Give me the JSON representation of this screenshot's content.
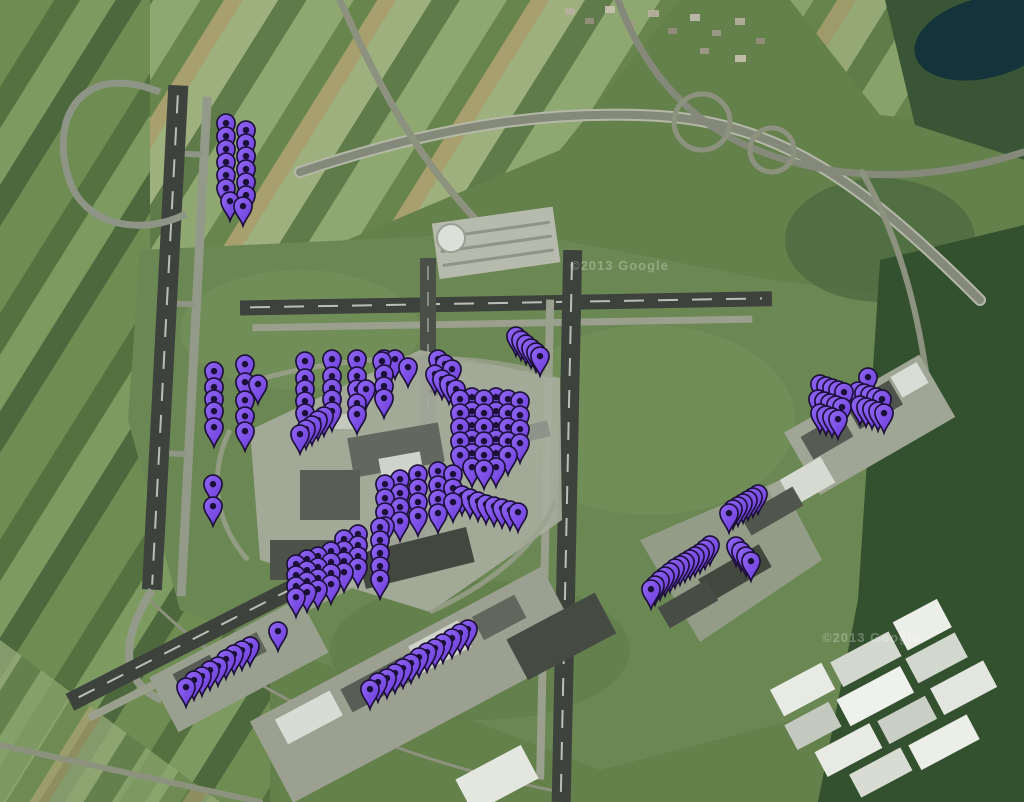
{
  "watermarks": [
    {
      "text": "©2013 Google"
    },
    {
      "text": "©2013 Google"
    }
  ],
  "markers": {
    "color": "#7a4ff0",
    "color_light": "#9168f4",
    "color_dark": "#6a3ad8",
    "outline": "#1c1038",
    "points": [
      [
        226,
        144
      ],
      [
        246,
        151
      ],
      [
        226,
        157
      ],
      [
        226,
        170
      ],
      [
        226,
        183
      ],
      [
        226,
        196
      ],
      [
        226,
        209
      ],
      [
        230,
        222
      ],
      [
        246,
        164
      ],
      [
        246,
        177
      ],
      [
        246,
        190
      ],
      [
        246,
        203
      ],
      [
        246,
        216
      ],
      [
        243,
        227
      ],
      [
        214,
        392
      ],
      [
        214,
        408
      ],
      [
        214,
        420
      ],
      [
        214,
        432
      ],
      [
        214,
        448
      ],
      [
        245,
        385
      ],
      [
        245,
        403
      ],
      [
        245,
        421
      ],
      [
        245,
        437
      ],
      [
        245,
        452
      ],
      [
        258,
        405
      ],
      [
        305,
        382
      ],
      [
        305,
        399
      ],
      [
        305,
        410
      ],
      [
        305,
        422
      ],
      [
        305,
        434
      ],
      [
        332,
        380
      ],
      [
        332,
        397
      ],
      [
        332,
        409
      ],
      [
        332,
        420
      ],
      [
        332,
        432
      ],
      [
        357,
        380
      ],
      [
        357,
        397
      ],
      [
        357,
        410
      ],
      [
        357,
        424
      ],
      [
        357,
        435
      ],
      [
        366,
        410
      ],
      [
        384,
        380
      ],
      [
        384,
        395
      ],
      [
        384,
        407
      ],
      [
        384,
        419
      ],
      [
        300,
        455
      ],
      [
        306,
        450
      ],
      [
        312,
        446
      ],
      [
        318,
        441
      ],
      [
        324,
        437
      ],
      [
        382,
        382
      ],
      [
        395,
        380
      ],
      [
        408,
        388
      ],
      [
        516,
        357
      ],
      [
        521,
        361
      ],
      [
        526,
        365
      ],
      [
        531,
        369
      ],
      [
        536,
        373
      ],
      [
        540,
        377
      ],
      [
        438,
        380
      ],
      [
        445,
        385
      ],
      [
        452,
        390
      ],
      [
        435,
        395
      ],
      [
        442,
        400
      ],
      [
        449,
        405
      ],
      [
        456,
        410
      ],
      [
        460,
        420
      ],
      [
        460,
        434
      ],
      [
        460,
        448
      ],
      [
        460,
        462
      ],
      [
        460,
        476
      ],
      [
        472,
        418
      ],
      [
        472,
        432
      ],
      [
        472,
        446
      ],
      [
        472,
        460
      ],
      [
        472,
        474
      ],
      [
        472,
        488
      ],
      [
        484,
        420
      ],
      [
        484,
        434
      ],
      [
        484,
        448
      ],
      [
        484,
        462
      ],
      [
        484,
        476
      ],
      [
        484,
        490
      ],
      [
        496,
        418
      ],
      [
        496,
        432
      ],
      [
        496,
        446
      ],
      [
        496,
        460
      ],
      [
        496,
        474
      ],
      [
        496,
        488
      ],
      [
        508,
        420
      ],
      [
        508,
        434
      ],
      [
        508,
        448
      ],
      [
        508,
        462
      ],
      [
        508,
        476
      ],
      [
        520,
        422
      ],
      [
        520,
        436
      ],
      [
        520,
        450
      ],
      [
        520,
        464
      ],
      [
        385,
        505
      ],
      [
        385,
        519
      ],
      [
        385,
        533
      ],
      [
        385,
        547
      ],
      [
        400,
        500
      ],
      [
        400,
        514
      ],
      [
        400,
        528
      ],
      [
        400,
        542
      ],
      [
        418,
        495
      ],
      [
        418,
        509
      ],
      [
        418,
        523
      ],
      [
        418,
        537
      ],
      [
        438,
        492
      ],
      [
        438,
        506
      ],
      [
        438,
        520
      ],
      [
        438,
        534
      ],
      [
        453,
        495
      ],
      [
        453,
        509
      ],
      [
        453,
        523
      ],
      [
        462,
        516
      ],
      [
        470,
        519
      ],
      [
        478,
        522
      ],
      [
        486,
        525
      ],
      [
        494,
        527
      ],
      [
        502,
        529
      ],
      [
        510,
        531
      ],
      [
        518,
        533
      ],
      [
        296,
        585
      ],
      [
        296,
        596
      ],
      [
        296,
        607
      ],
      [
        296,
        618
      ],
      [
        307,
        580
      ],
      [
        307,
        591
      ],
      [
        307,
        602
      ],
      [
        307,
        613
      ],
      [
        318,
        577
      ],
      [
        318,
        588
      ],
      [
        318,
        599
      ],
      [
        318,
        610
      ],
      [
        331,
        572
      ],
      [
        331,
        583
      ],
      [
        331,
        594
      ],
      [
        331,
        605
      ],
      [
        344,
        560
      ],
      [
        344,
        571
      ],
      [
        344,
        582
      ],
      [
        344,
        593
      ],
      [
        358,
        555
      ],
      [
        358,
        566
      ],
      [
        358,
        577
      ],
      [
        358,
        588
      ],
      [
        380,
        548
      ],
      [
        380,
        561
      ],
      [
        380,
        574
      ],
      [
        380,
        587
      ],
      [
        380,
        600
      ],
      [
        213,
        505
      ],
      [
        213,
        527
      ],
      [
        278,
        652
      ],
      [
        186,
        708
      ],
      [
        194,
        701
      ],
      [
        202,
        697
      ],
      [
        210,
        691
      ],
      [
        218,
        687
      ],
      [
        226,
        680
      ],
      [
        234,
        675
      ],
      [
        242,
        671
      ],
      [
        250,
        667
      ],
      [
        370,
        710
      ],
      [
        378,
        703
      ],
      [
        387,
        699
      ],
      [
        395,
        694
      ],
      [
        403,
        689
      ],
      [
        411,
        684
      ],
      [
        419,
        678
      ],
      [
        427,
        673
      ],
      [
        435,
        669
      ],
      [
        443,
        664
      ],
      [
        452,
        659
      ],
      [
        460,
        654
      ],
      [
        468,
        650
      ],
      [
        820,
        405
      ],
      [
        826,
        407
      ],
      [
        832,
        409
      ],
      [
        838,
        411
      ],
      [
        844,
        413
      ],
      [
        818,
        420
      ],
      [
        824,
        422
      ],
      [
        830,
        424
      ],
      [
        836,
        426
      ],
      [
        842,
        428
      ],
      [
        820,
        434
      ],
      [
        826,
        436
      ],
      [
        832,
        438
      ],
      [
        838,
        440
      ],
      [
        868,
        398
      ],
      [
        858,
        412
      ],
      [
        864,
        414
      ],
      [
        870,
        416
      ],
      [
        876,
        418
      ],
      [
        882,
        420
      ],
      [
        860,
        426
      ],
      [
        866,
        428
      ],
      [
        872,
        430
      ],
      [
        878,
        432
      ],
      [
        884,
        434
      ],
      [
        758,
        515
      ],
      [
        753,
        518
      ],
      [
        748,
        521
      ],
      [
        743,
        524
      ],
      [
        738,
        527
      ],
      [
        733,
        530
      ],
      [
        729,
        534
      ],
      [
        710,
        566
      ],
      [
        705,
        570
      ],
      [
        700,
        574
      ],
      [
        695,
        577
      ],
      [
        690,
        580
      ],
      [
        685,
        583
      ],
      [
        680,
        586
      ],
      [
        675,
        589
      ],
      [
        670,
        593
      ],
      [
        665,
        597
      ],
      [
        660,
        601
      ],
      [
        655,
        606
      ],
      [
        651,
        610
      ],
      [
        736,
        567
      ],
      [
        741,
        572
      ],
      [
        746,
        577
      ],
      [
        751,
        582
      ]
    ]
  }
}
